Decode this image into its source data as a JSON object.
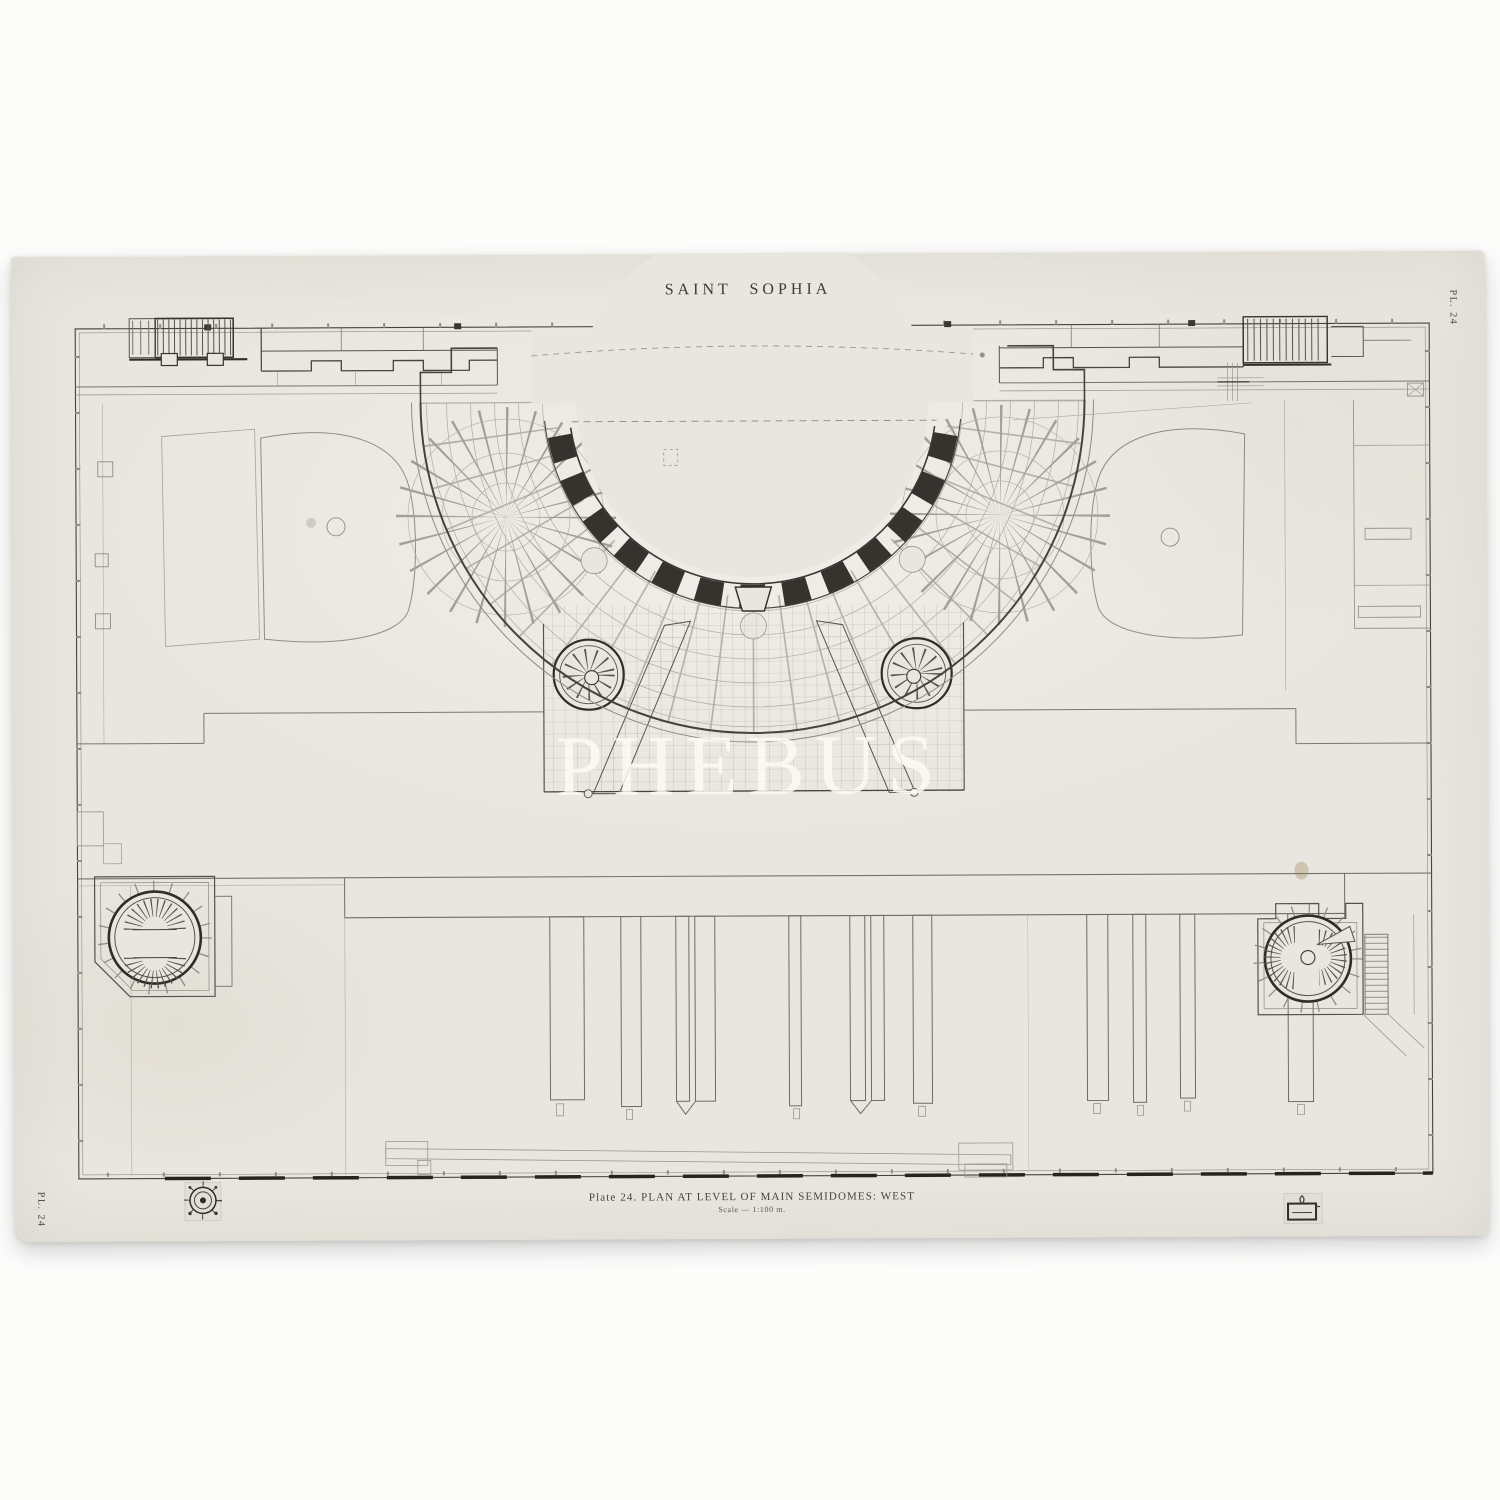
{
  "sheet": {
    "title": "SAINT SOPHIA",
    "plate_label_top_right": "PL. 24",
    "plate_label_bottom_left": "PL. 24",
    "caption": "Plate 24. PLAN AT LEVEL OF MAIN SEMIDOMES: WEST",
    "scale_note": "Scale — 1:100 m.",
    "watermark": "PHEBUS",
    "colors": {
      "paper": "#e9e6df",
      "ink_dark": "#302e2a",
      "ink_medium": "#6f6c65",
      "ink_light": "#aaa69d",
      "background": "#fcfcfb",
      "watermark_text": "#fbfaf6"
    },
    "icons": {
      "compass_stamp": "compass-rose-stamp-icon",
      "publisher_stamp": "publisher-mark-stamp-icon"
    }
  }
}
